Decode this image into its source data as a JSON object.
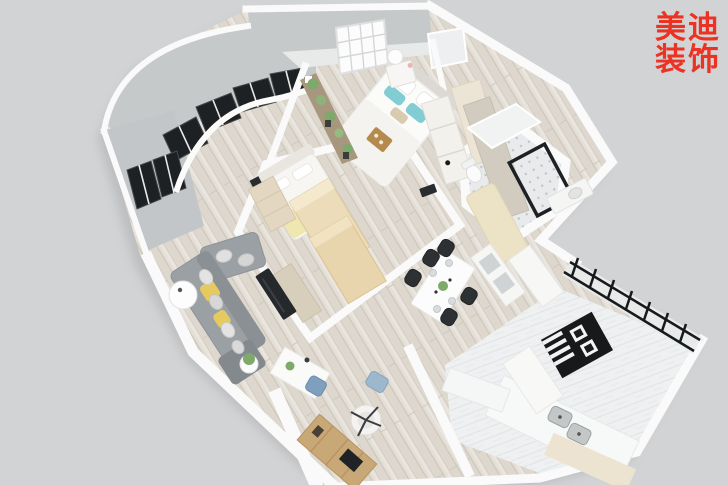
{
  "logo": {
    "line1": "美迪",
    "line2": "装饰",
    "color": "#ec3323"
  },
  "palette": {
    "background": "#d2d3d4",
    "wall_top": "#fafafa",
    "wall_face": "#c6c9ca",
    "wood_floor": "#e3ded6",
    "tile_floor": "#e9eaec",
    "kitchen_floor": "#eef0f1",
    "window_frame": "#1e2124",
    "sofa_gray": "#9aa0a4",
    "accent_yellow": "#e6c95f",
    "accent_teal": "#82ccd4",
    "accent_blue": "#7f9fbe",
    "tv_black": "#26292c",
    "wood_furniture": "#c9a877",
    "cream": "#ece2c6",
    "appliance_black": "#17191b"
  },
  "scene": {
    "type": "3d-floorplan-render",
    "rooms": [
      {
        "name": "curved-bay-window"
      },
      {
        "name": "master-bedroom"
      },
      {
        "name": "bathroom"
      },
      {
        "name": "second-bedroom"
      },
      {
        "name": "living-room"
      },
      {
        "name": "dining-area"
      },
      {
        "name": "kitchen"
      },
      {
        "name": "study-area"
      }
    ],
    "furniture": [
      "double-bed",
      "nightstand-with-lamp",
      "plant-shelf",
      "wardrobe",
      "shower-enclosure",
      "bathtub-mat",
      "single-bed",
      "storage-boxes",
      "dresser",
      "l-shaped-sofa",
      "tv-panel",
      "round-side-table",
      "dining-table",
      "dining-chairs",
      "sideboard",
      "glass-partition",
      "gas-stove",
      "sink-counter",
      "desk",
      "desk-chair",
      "armchair",
      "bookshelf-with-laptop"
    ]
  }
}
